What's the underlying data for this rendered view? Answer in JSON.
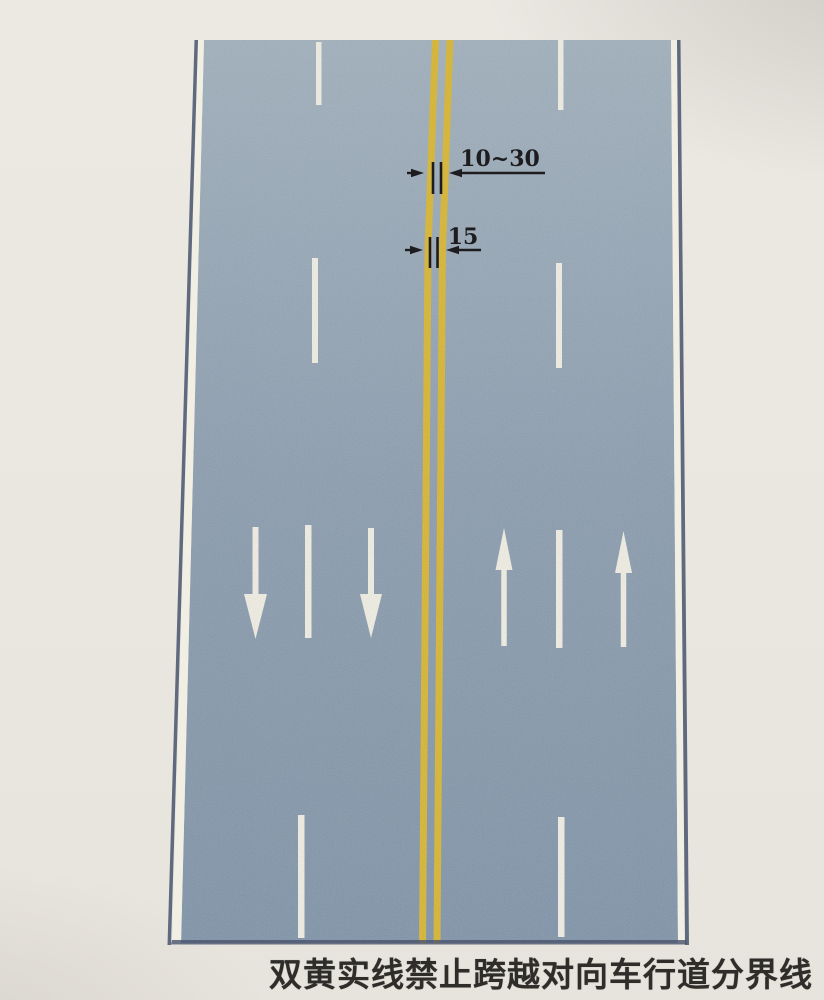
{
  "caption": "双黄实线禁止跨越对向车行道分界线",
  "colors": {
    "background": "#eae7e0",
    "background_top": "#ece9e3",
    "background_bottom": "#e7e4dd",
    "road_top": "#a0b0bd",
    "road_mid": "#8a9cae",
    "road_bottom": "#7e93a8",
    "marking_white": "#f1efe4",
    "center_line_yellow": "#d8b52e",
    "edge_dark": "#48546d",
    "annotation_black": "#1d1d20",
    "caption_color": "#2e2d2a"
  },
  "diagram": {
    "road": {
      "surface": [
        [
          204,
          40
        ],
        [
          671,
          40
        ],
        [
          678,
          943
        ],
        [
          181,
          943
        ]
      ],
      "left_white_edge": [
        [
          198,
          40
        ],
        [
          204,
          40
        ],
        [
          181,
          945
        ],
        [
          172,
          945
        ]
      ],
      "left_dark_outline": [
        [
          194.5,
          40
        ],
        [
          198,
          40
        ],
        [
          171,
          945
        ],
        [
          167.5,
          945
        ]
      ],
      "right_white_edge": [
        [
          671,
          40
        ],
        [
          677,
          40
        ],
        [
          685,
          943
        ],
        [
          678,
          943
        ]
      ],
      "right_dark_outline": [
        [
          677,
          40
        ],
        [
          680.5,
          40
        ],
        [
          689,
          945
        ],
        [
          685,
          945
        ]
      ],
      "bottom_dark_outline": [
        [
          172,
          940
        ],
        [
          686,
          940
        ],
        [
          687,
          944.5
        ],
        [
          171,
          944.5
        ]
      ]
    },
    "center_line": {
      "type": "double-yellow-solid",
      "left_line": [
        [
          432,
          40
        ],
        [
          439,
          40
        ],
        [
          431.5,
          250
        ],
        [
          426,
          943
        ],
        [
          419,
          943
        ],
        [
          424.5,
          250
        ]
      ],
      "right_line": [
        [
          446.5,
          40
        ],
        [
          453.5,
          40
        ],
        [
          446,
          250
        ],
        [
          440.5,
          943
        ],
        [
          433.5,
          943
        ],
        [
          439,
          250
        ]
      ]
    },
    "lane_dashes": {
      "left": [
        [
          316,
          42,
          105,
          5.5
        ],
        [
          312,
          258,
          363,
          6
        ],
        [
          305,
          525,
          638,
          6.5
        ],
        [
          298,
          815,
          938,
          6.5
        ]
      ],
      "right": [
        [
          558,
          40,
          110,
          5.5
        ],
        [
          556,
          263,
          368,
          6
        ],
        [
          556,
          530,
          648,
          6.5
        ],
        [
          558,
          817,
          937,
          6.5
        ]
      ]
    },
    "arrows": [
      {
        "dir": "down",
        "cx": 255.5,
        "stem_start": 527,
        "head_base": 594,
        "tip": 639,
        "head_w": 23,
        "stem_w": 6
      },
      {
        "dir": "down",
        "cx": 371,
        "stem_start": 528,
        "head_base": 594,
        "tip": 638,
        "head_w": 22,
        "stem_w": 6
      },
      {
        "dir": "up",
        "cx": 504,
        "stem_start": 646,
        "head_base": 570,
        "tip": 528,
        "head_w": 17,
        "stem_w": 5.5
      },
      {
        "dir": "up",
        "cx": 623.5,
        "stem_start": 647,
        "head_base": 573,
        "tip": 531,
        "head_w": 17,
        "stem_w": 5.5
      }
    ],
    "dimensions": [
      {
        "label": "10~30",
        "y": 173,
        "tail_left": [
          407,
          424
        ],
        "ticks": [
          433,
          441
        ],
        "tick_span": [
          162,
          194
        ],
        "tail_right": [
          449,
          545
        ],
        "label_cx": 500,
        "label_baseline": 166,
        "font_size": 22
      },
      {
        "label": "15",
        "y": 250,
        "tail_left": [
          405,
          423
        ],
        "ticks": [
          430,
          437.5
        ],
        "tick_span": [
          237,
          268
        ],
        "tail_right": [
          446,
          481
        ],
        "label_cx": 463,
        "label_baseline": 244,
        "font_size": 22
      }
    ]
  }
}
